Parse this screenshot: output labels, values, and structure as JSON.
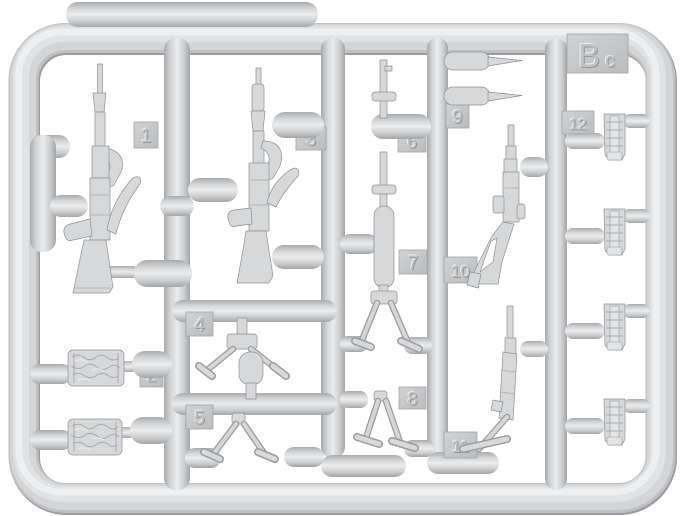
{
  "sprue_plate": {
    "code_tab": {
      "large": "B",
      "small": "c"
    },
    "part_tabs": [
      {
        "number": "1"
      },
      {
        "number": "2"
      },
      {
        "number": "3"
      },
      {
        "number": "4"
      },
      {
        "number": "5"
      },
      {
        "number": "6"
      },
      {
        "number": "7"
      },
      {
        "number": "8"
      },
      {
        "number": "9"
      },
      {
        "number": "10"
      },
      {
        "number": "11"
      },
      {
        "number": "12"
      }
    ],
    "colors": {
      "plastic_base": "#d4d6d8",
      "plastic_highlight": "#ebedef",
      "plastic_shadow": "#a4a6a8",
      "tab_face": "#c6c8ca",
      "background": "#ffffff"
    }
  }
}
